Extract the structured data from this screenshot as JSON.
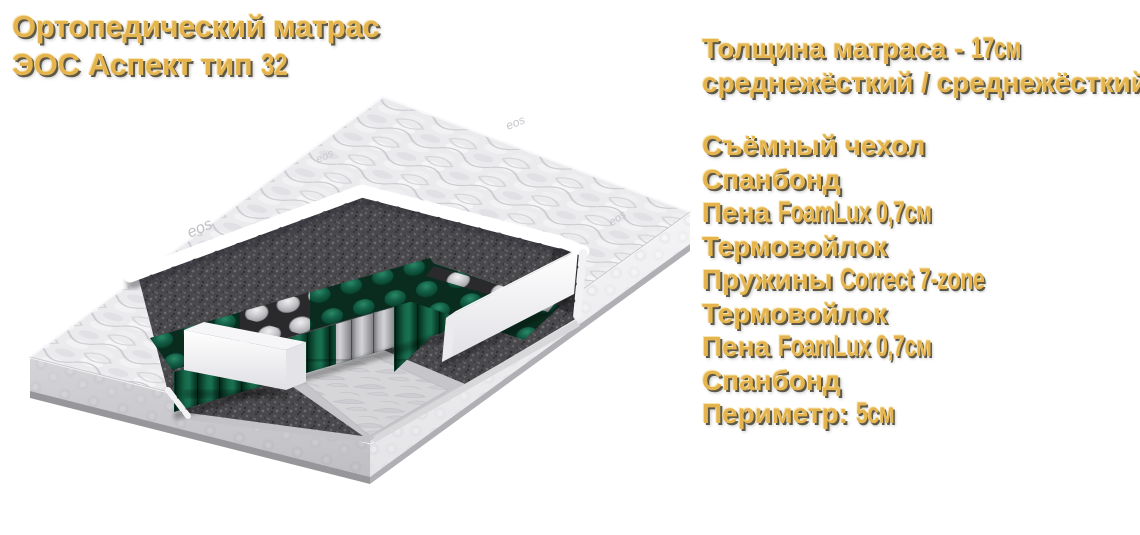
{
  "title": {
    "line1": "Ортопедический матрас",
    "line2_text": "ЭОС Аспект тип ",
    "line2_cond": "32"
  },
  "specs": {
    "thickness_label": "Толщина матраса - ",
    "thickness_value": "17см",
    "firmness": "среднежёсткий / среднежёсткий"
  },
  "layers": [
    {
      "text": "Съёмный чехол",
      "cond": ""
    },
    {
      "text": "Спанбонд",
      "cond": ""
    },
    {
      "text": "Пена ",
      "cond": "FoamLux 0,7см"
    },
    {
      "text": "Термовойлок",
      "cond": ""
    },
    {
      "text": "Пружины ",
      "cond": "Correct 7-zone"
    },
    {
      "text": "Термовойлок",
      "cond": ""
    },
    {
      "text": "Пена ",
      "cond": "FoamLux 0,7см"
    },
    {
      "text": "Спанбонд",
      "cond": ""
    },
    {
      "text": "Периметр: ",
      "cond": "5см"
    }
  ],
  "mattress": {
    "brand_logo": "eos"
  },
  "colors": {
    "accent_gold": "#e5b44e",
    "text_shadow": "#5e5947",
    "spring_green": "#0e5038",
    "felt_gray": "#49494c",
    "foam_white": "#f6f6f8"
  }
}
